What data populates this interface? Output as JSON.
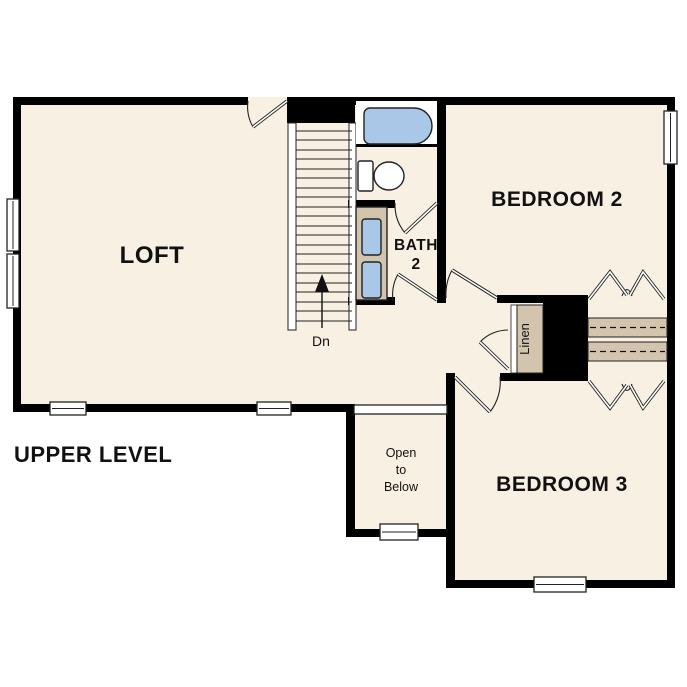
{
  "title": "UPPER LEVEL",
  "labels": {
    "loft": "LOFT",
    "bath_line1": "BATH",
    "bath_line2": "2",
    "bedroom2": "BEDROOM 2",
    "bedroom3": "BEDROOM 3",
    "linen": "Linen",
    "stair_direction": "Dn",
    "open_below_line1": "Open",
    "open_below_line2": "to",
    "open_below_line3": "Below"
  },
  "colors": {
    "background": "#ffffff",
    "floor": "#f7f0e3",
    "wall": "#000000",
    "fixture_blue": "#a9c8e8",
    "casework_tan": "#d3c4ae",
    "outline": "#222222"
  }
}
